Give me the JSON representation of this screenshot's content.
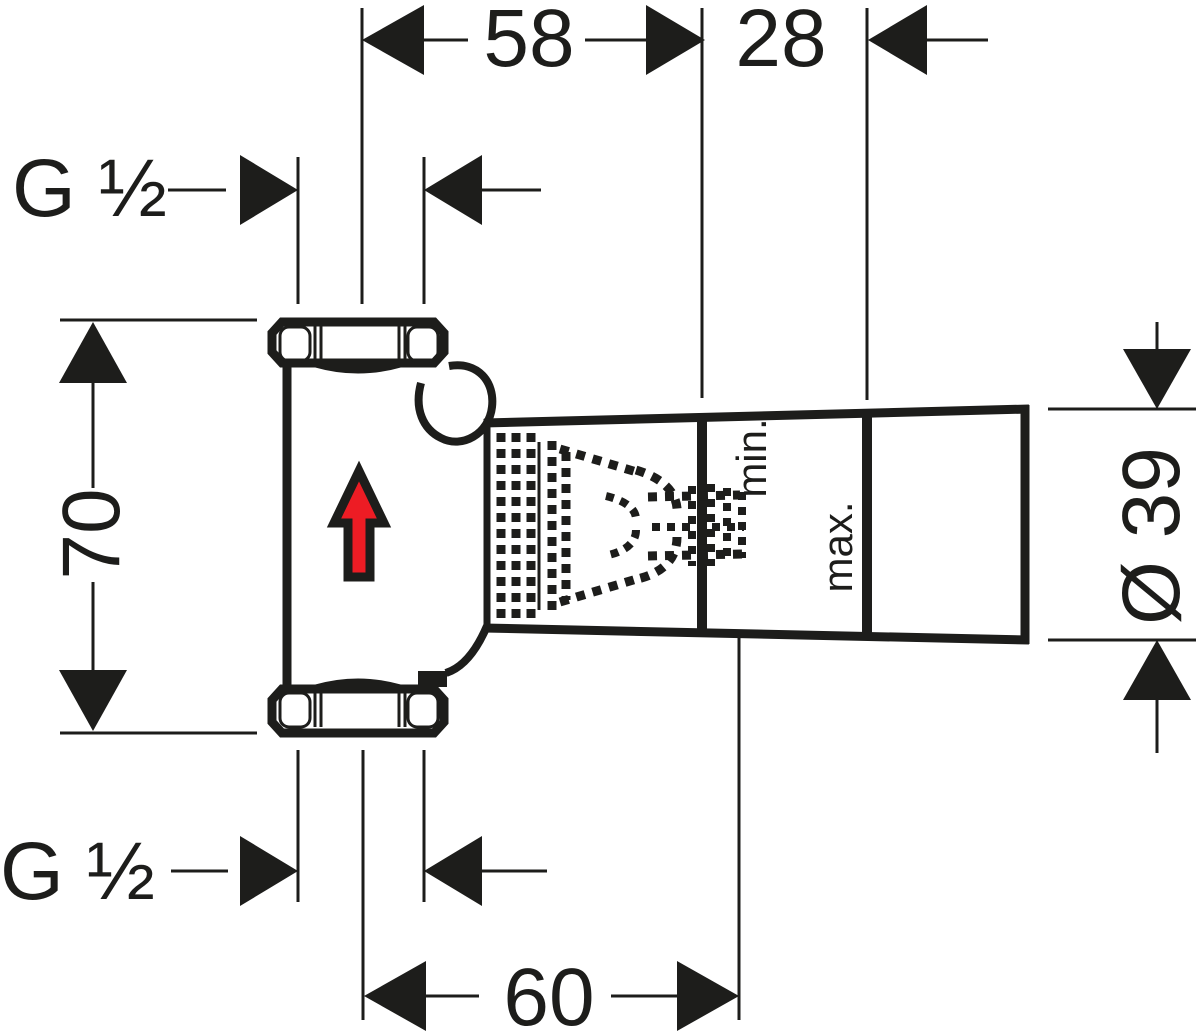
{
  "meta": {
    "title": "Technical dimension drawing — concealed shut-off valve rough-in body, side view",
    "width_px": 1200,
    "height_px": 1031
  },
  "colors": {
    "ink": "#1d1d1b",
    "paper": "#ffffff",
    "flow_arrow_red": "#ed1c24"
  },
  "dimensions": {
    "top_width": {
      "label": "58",
      "orientation": "horizontal"
    },
    "top_offset": {
      "label": "28",
      "orientation": "horizontal"
    },
    "thread_top": {
      "label": "G ½",
      "orientation": "horizontal"
    },
    "thread_bottom": {
      "label": "G ½",
      "orientation": "horizontal"
    },
    "body_height": {
      "label": "70",
      "orientation": "vertical"
    },
    "sleeve_diameter": {
      "label": "Ø 39",
      "orientation": "vertical"
    },
    "bottom_width": {
      "label": "60",
      "orientation": "horizontal"
    }
  },
  "annotations": {
    "plaster_min": {
      "label": "min."
    },
    "plaster_max": {
      "label": "max."
    }
  },
  "icons": {
    "flow_direction": "red-up-arrow"
  }
}
